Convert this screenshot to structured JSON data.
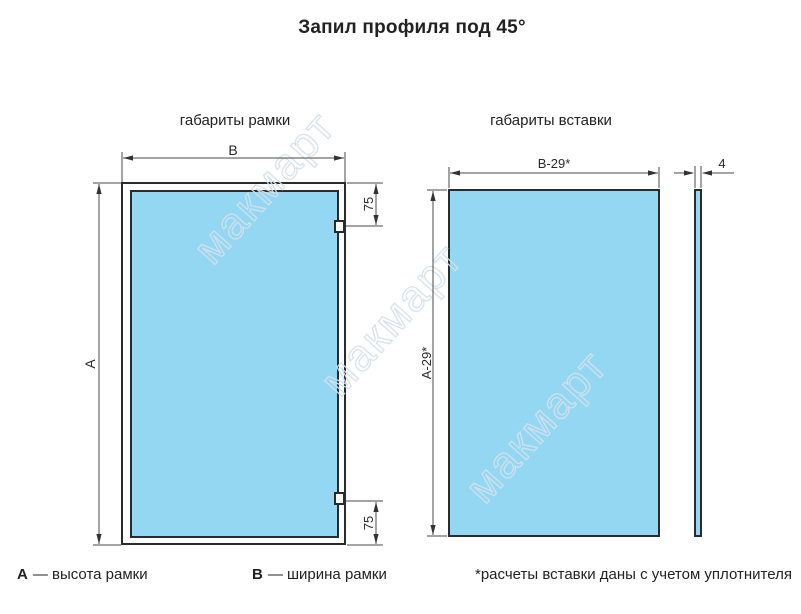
{
  "title": "Запил профиля под 45°",
  "watermark": {
    "text": "макмарт"
  },
  "colors": {
    "panel_fill": "#93d7f3",
    "outline": "#2b2b2b",
    "dimension_line": "#4a4a4a",
    "text": "#222222"
  },
  "frame_diagram": {
    "label": "габариты рамки",
    "dims": {
      "width": "B",
      "height": "A",
      "hinge_top_offset": "75",
      "hinge_bottom_offset": "75"
    }
  },
  "insert_diagram": {
    "label": "габариты вставки",
    "dims": {
      "width": "B-29*",
      "height": "A-29*",
      "thickness": "4"
    }
  },
  "legend": {
    "a_symbol": "A",
    "a_text": "— высота рамки",
    "b_symbol": "B",
    "b_text": "— ширина рамки",
    "footnote": "*расчеты вставки даны с учетом уплотнителя"
  }
}
